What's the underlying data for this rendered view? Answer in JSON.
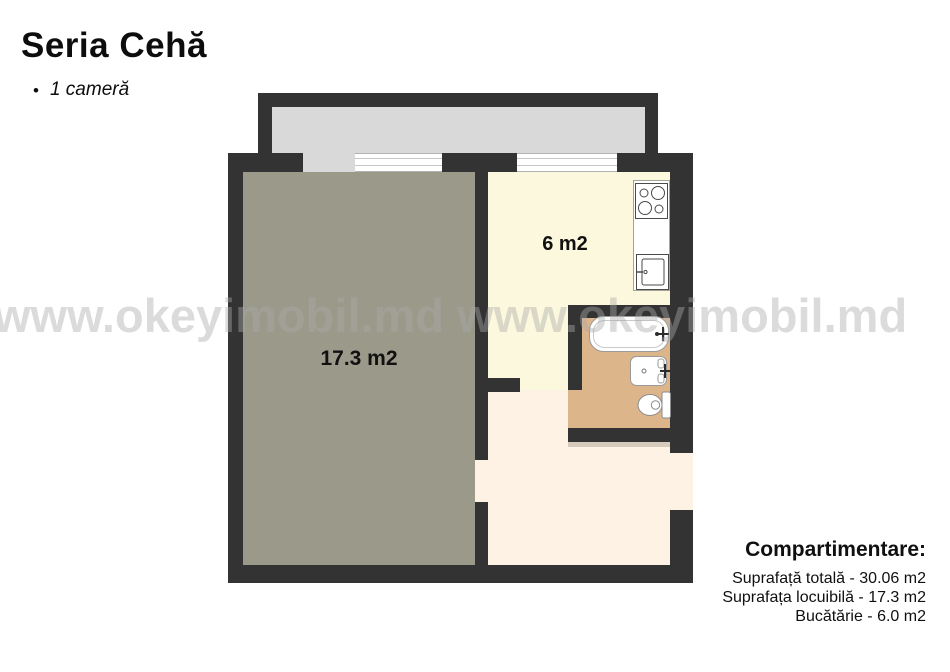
{
  "header": {
    "title": "Seria Cehă",
    "bullet": "•",
    "subtitle": "1 cameră"
  },
  "watermark": {
    "text": "www.okeyimobil.md www.okeyimobil.md"
  },
  "floorplan": {
    "labels": {
      "living_room": "17.3 m2",
      "kitchen": "6 m2"
    },
    "colors": {
      "wall": "#333333",
      "living_room": "#9b998a",
      "kitchen": "#fcf8dd",
      "hallway": "#fdf2e4",
      "bathroom": "#ddb58a",
      "balcony": "#d9d9d9",
      "window": "#ffffff"
    },
    "fixtures": [
      "stove-icon",
      "kitchen-sink-icon",
      "bathtub-icon",
      "washbasin-icon",
      "toilet-icon"
    ]
  },
  "legend": {
    "title": "Compartimentare:",
    "lines": [
      "Suprafață totală - 30.06 m2",
      "Suprafața locuibilă - 17.3 m2",
      "Bucătărie - 6.0 m2"
    ]
  }
}
